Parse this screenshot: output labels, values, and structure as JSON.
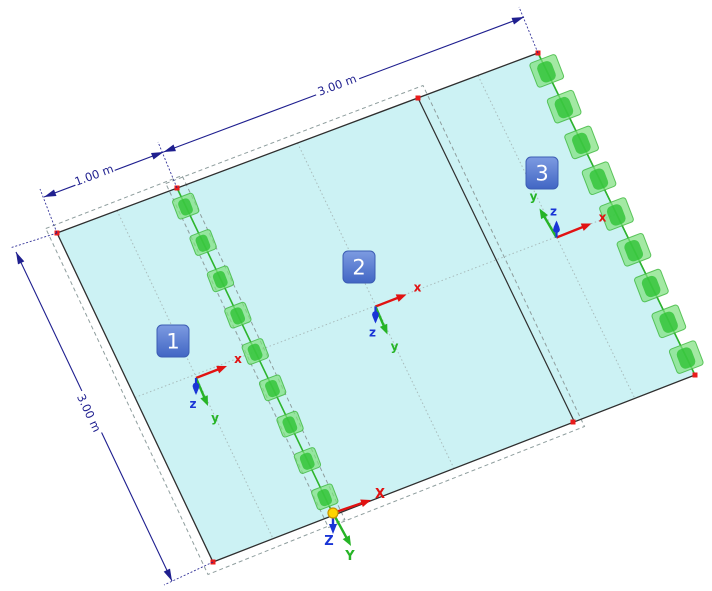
{
  "canvas": {
    "width": 712,
    "height": 591
  },
  "colors": {
    "background": "#ffffff",
    "surface_fill": "#ccf2f4",
    "surface_edge": "#2e2e2e",
    "grid_line": "#a9bcbc",
    "selection_dash": "#8f9e9e",
    "support_light": "#7fe07f",
    "support_mid": "#3db83d",
    "support_dark": "#2cc232",
    "support_line": "#2db52d",
    "node_red": "#ea1c1c",
    "dimension": "#1f1f8f",
    "badge_top": "#7d9be1",
    "badge_bottom": "#4166c4",
    "badge_border": "#3c5db4",
    "badge_text": "#ffffff",
    "axis_x": "#e11212",
    "axis_y": "#26b426",
    "axis_z": "#1a35d6",
    "origin_fill": "#ffd400",
    "origin_stroke": "#c89200"
  },
  "plate": {
    "corners": [
      [
        57,
        233
      ],
      [
        538,
        53
      ],
      [
        695,
        375
      ],
      [
        213,
        562
      ]
    ],
    "boundary_2_3": [
      [
        418,
        98
      ],
      [
        574.5,
        422
      ]
    ],
    "support_line": [
      [
        177,
        188
      ],
      [
        333.5,
        515
      ]
    ],
    "centroid_lines": [
      [
        [
          135,
          397.5
        ],
        [
          616.5,
          214
        ]
      ],
      [
        [
          117,
          210.5
        ],
        [
          273,
          538.6
        ]
      ],
      [
        [
          297.5,
          143
        ],
        [
          454,
          468.5
        ]
      ],
      [
        [
          478,
          75.5
        ],
        [
          634.8,
          398.4
        ]
      ]
    ],
    "selection_outlines": [
      [
        [
          45.8,
          228.5
        ],
        [
          182,
          175.5
        ],
        [
          344.8,
          519.5
        ],
        [
          208,
          574.5
        ]
      ],
      [
        [
          165.8,
          183.5
        ],
        [
          423,
          85.5
        ],
        [
          584.5,
          426.5
        ],
        [
          328.5,
          527.5
        ]
      ]
    ],
    "nodes": [
      [
        57,
        233
      ],
      [
        177,
        188
      ],
      [
        538,
        53
      ],
      [
        418,
        98
      ],
      [
        695,
        375
      ],
      [
        573,
        422
      ],
      [
        213,
        562
      ]
    ]
  },
  "supports": {
    "angle": -21,
    "line_count": 9,
    "line_size": [
      22,
      21
    ],
    "edge_count": 9,
    "edge_size": [
      28,
      26
    ]
  },
  "surfaces": [
    {
      "label": "1",
      "badge": [
        173,
        341
      ],
      "triad": [
        196,
        378
      ],
      "z_dir": 1
    },
    {
      "label": "2",
      "badge": [
        359,
        267
      ],
      "triad": [
        375.5,
        306.5
      ],
      "z_dir": 1
    },
    {
      "label": "3",
      "badge": [
        542,
        173
      ],
      "triad": [
        556.5,
        237.5
      ],
      "z_dir": -1
    }
  ],
  "axis_labels": {
    "x": "x",
    "y": "y",
    "z": "z"
  },
  "global_axes": {
    "origin": [
      333,
      513
    ],
    "labels": {
      "x": "X",
      "y": "Y",
      "z": "Z"
    }
  },
  "dimensions": [
    {
      "label": "1.00 m",
      "from": [
        44,
        197
      ],
      "to": [
        163.5,
        152
      ],
      "text": [
        94,
        175
      ],
      "angle": -20.5,
      "gap": 42,
      "extensions": [
        [
          [
            57,
            233
          ],
          [
            40,
            189
          ]
        ],
        [
          [
            177,
            188
          ],
          [
            158,
            142
          ]
        ]
      ]
    },
    {
      "label": "3.00 m",
      "from": [
        163.5,
        152
      ],
      "to": [
        524,
        17
      ],
      "text": [
        337,
        85
      ],
      "angle": -20.5,
      "gap": 46,
      "extensions": [
        [
          [
            538,
            53
          ],
          [
            519,
            7
          ]
        ]
      ]
    },
    {
      "label": "3.00 m",
      "from": [
        16,
        252
      ],
      "to": [
        172,
        581
      ],
      "text": [
        89,
        413
      ],
      "angle": 64.6,
      "gap": 46,
      "extensions": [
        [
          [
            57,
            233
          ],
          [
            10,
            248
          ]
        ],
        [
          [
            213,
            562
          ],
          [
            164,
            585
          ]
        ]
      ]
    }
  ]
}
